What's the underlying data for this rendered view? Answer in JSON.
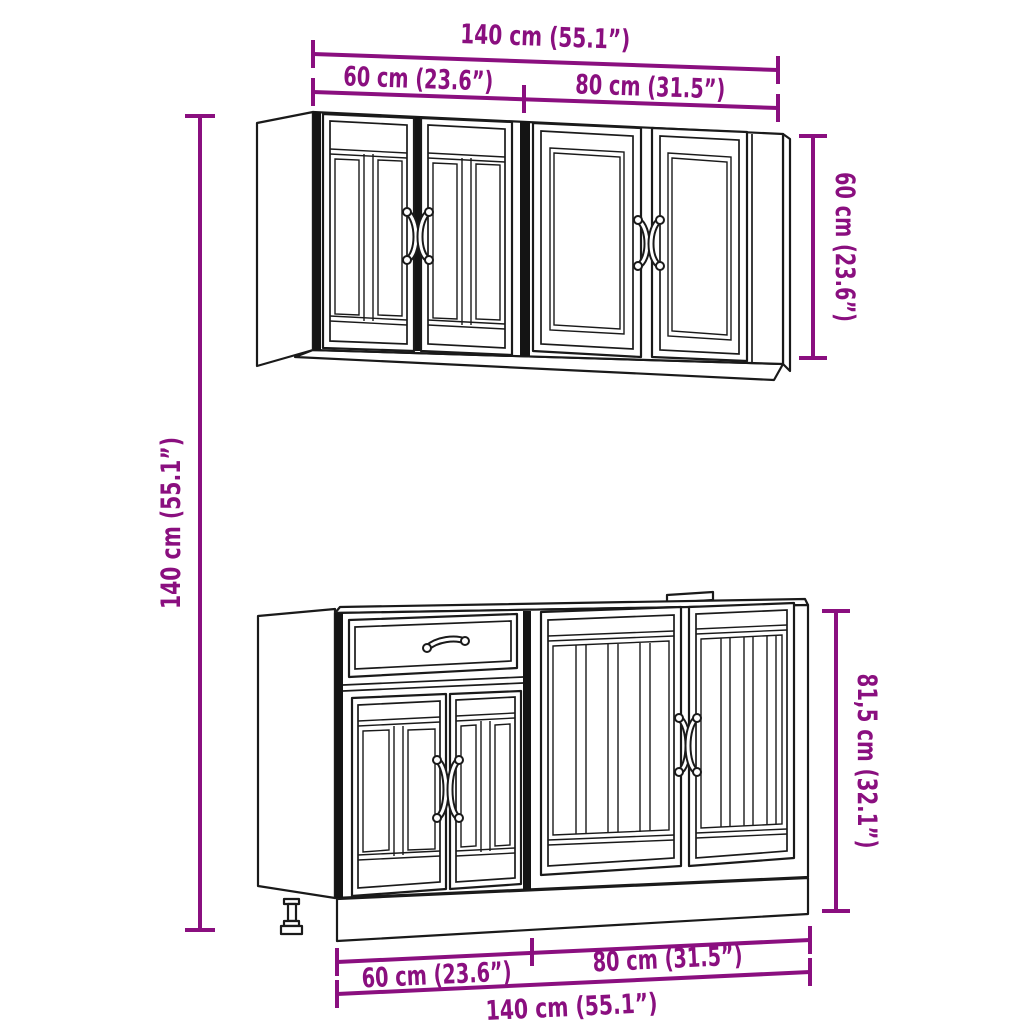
{
  "accent_color": "#8a0f7f",
  "line_color": "#1a1a1a",
  "dims": {
    "top_total": "140 cm (55.1”)",
    "top_left": "60 cm (23.6”)",
    "top_right": "80 cm (31.5”)",
    "wall_height": "60 cm (23.6”)",
    "total_height": "140 cm (55.1”)",
    "base_height": "81,5 cm (32.1”)",
    "bottom_left": "60 cm (23.6”)",
    "bottom_right": "80 cm (31.5”)",
    "bottom_total": "140 cm (55.1”)"
  }
}
